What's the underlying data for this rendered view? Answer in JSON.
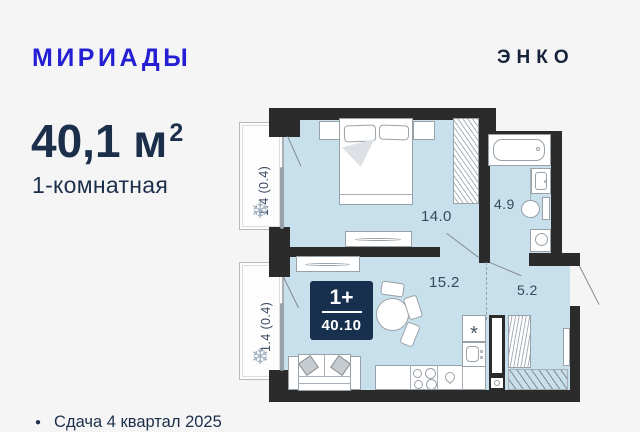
{
  "header": {
    "brand": "МИРИАДЫ",
    "developer": "ЭНКО"
  },
  "summary": {
    "area": "40,1 м",
    "area_sup": "2",
    "type": "1-комнатная"
  },
  "plan": {
    "badge": {
      "rooms": "1+",
      "area": "40.10"
    },
    "labels": {
      "bedroom": "14.0",
      "bathroom": "4.9",
      "living": "15.2",
      "hall": "5.2",
      "balcony_top": "1.4 (0.4)",
      "balcony_bottom": "1.4 (0.4)"
    },
    "icons": {
      "snowflake": "❄",
      "burner": "*"
    }
  },
  "footer": {
    "bullet": "●",
    "delivery": "Сдача 4 квартал 2025"
  },
  "colors": {
    "brand_blue": "#241fd2",
    "navy": "#1c2f4a",
    "floor_fill": "#c8dfec",
    "wall": "#2b2b2b",
    "badge_bg": "#16304e",
    "label": "#37495f"
  }
}
